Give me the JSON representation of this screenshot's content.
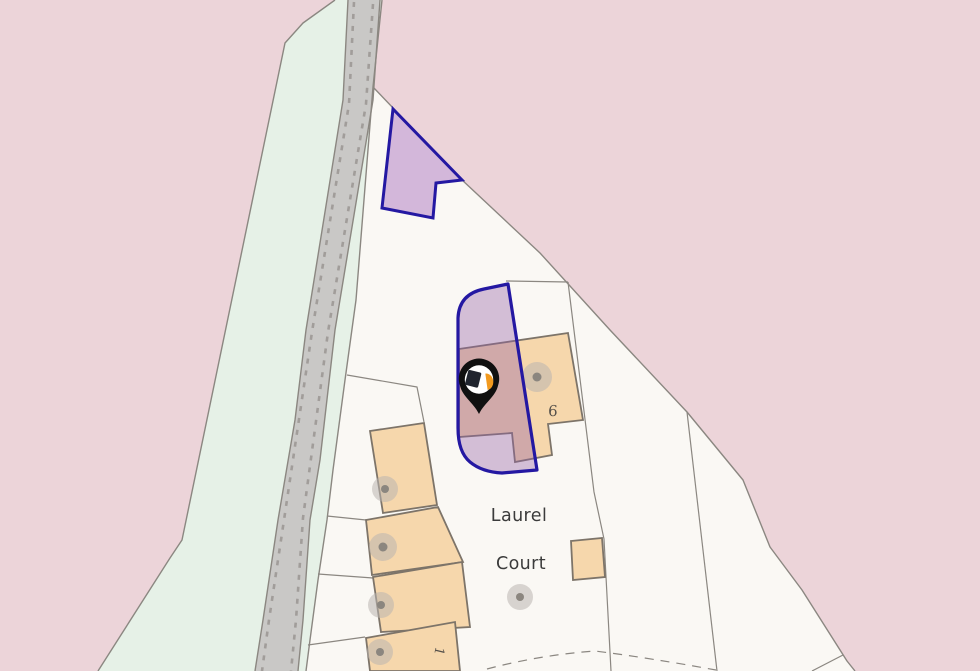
{
  "map": {
    "street_label": {
      "line1": "Laurel",
      "line2": "Court"
    },
    "house_numbers": {
      "plot6": "6",
      "plot1": "1"
    },
    "marker": {
      "name": "property-location-pin",
      "description": "black map pin with agency logo over highlighted parcel"
    },
    "features": {
      "highlighted_parcels": 2,
      "buildings": 6,
      "tree_symbols": 6,
      "road": "grey road with dashed edge lines inside green verge corridor"
    }
  },
  "colors": {
    "background_pink": "#ecd4d9",
    "land_white": "#faf8f4",
    "greenspace": "#e6f1e7",
    "road_grey": "#c9c8c6",
    "road_dash": "#a19d9a",
    "boundary_line": "#8b8781",
    "building_fill": "#f6d7ac",
    "building_outline": "#7d7469",
    "parcel_top_fill": "#d3b7da",
    "parcel_overlay": "rgba(146,94,166,0.38)",
    "parcel_outline": "#2418a2",
    "tree_halo": "#b9b4b0",
    "tree_dot": "#8b867f",
    "label_text": "#3b3b3b",
    "number_text": "#55504a",
    "pin_black": "#101010",
    "pin_white": "#ffffff",
    "pin_logo_dark": "#20242e",
    "pin_logo_orange": "#f29a1f"
  }
}
